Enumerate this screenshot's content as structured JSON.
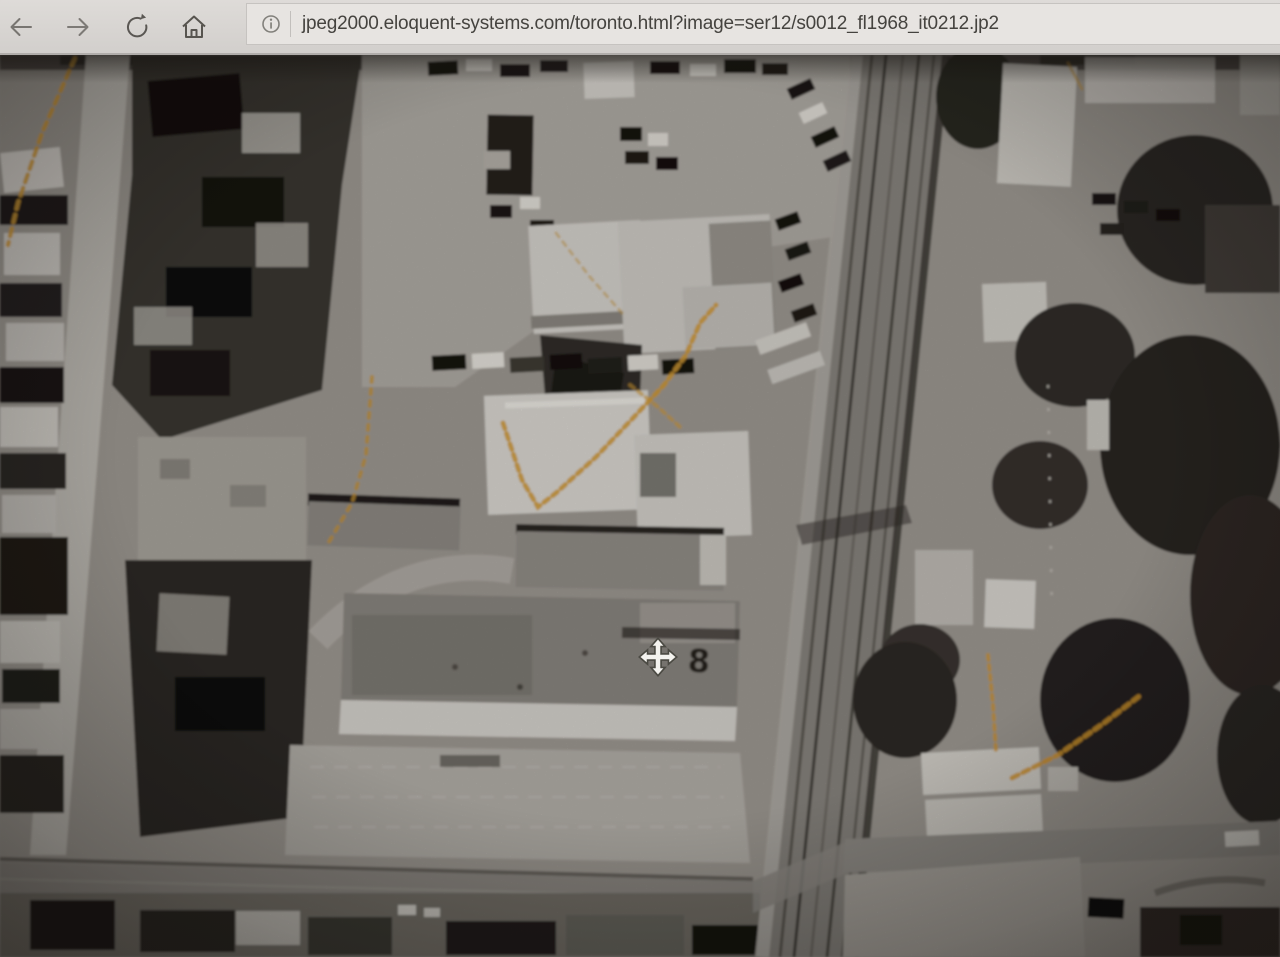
{
  "browser": {
    "url": "jpeg2000.eloquent-systems.com/toronto.html?image=ser12/s0012_fl1968_it0212.jp2",
    "icons": {
      "back": "arrow-left",
      "forward": "arrow-right",
      "refresh": "circular-arrow",
      "home": "house-outline",
      "info": "circled-i"
    }
  },
  "photo": {
    "plate_label": "8",
    "pan_cursor": "move-cross",
    "description": "Black-and-white 1968 aerial photograph of Toronto city blocks: industrial flat-roof buildings at centre, a diagonal rail corridor at right, residential streets at left, orange film scratches",
    "scratch_color": "#d39b33"
  },
  "colors": {
    "chrome_bg": "#d8d5d2",
    "address_bar_bg": "#e7e4e1",
    "url_text": "#45433f",
    "photo_midtone": "#a19d97"
  }
}
